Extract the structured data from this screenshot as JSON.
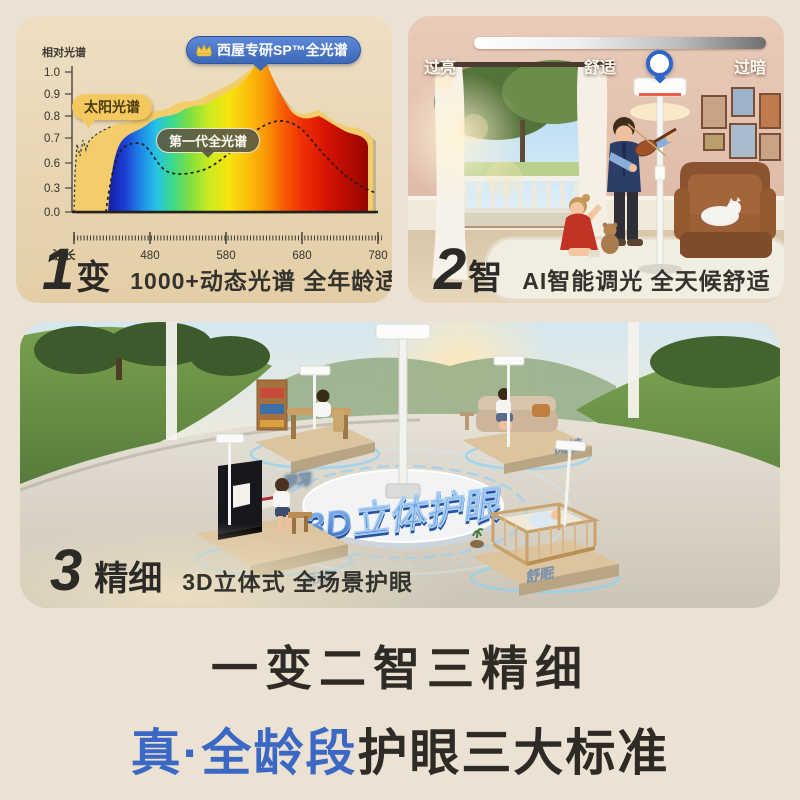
{
  "page": {
    "background": "#ebe2d3"
  },
  "panel_spectrum": {
    "axis_y_label": "相对光谱",
    "y_ticks": [
      "1.0",
      "0.9",
      "0.8",
      "0.7",
      "0.6",
      "0.3",
      "0.0"
    ],
    "axis_x_label": "波长",
    "x_ticks": [
      "480",
      "580",
      "680",
      "780"
    ],
    "badge_title": "西屋专研SP™全光谱",
    "label_sun": "太阳光谱",
    "label_gen1": "第一代全光谱",
    "index": "1",
    "keyword": "变",
    "caption": "1000+动态光谱 全年龄适配"
  },
  "panel_dimming": {
    "label_left": "过亮",
    "label_center": "舒适",
    "label_right": "过暗",
    "slider_value_percent": 55,
    "index": "2",
    "keyword": "智",
    "caption": "AI智能调光 全天候舒适"
  },
  "panel_scene": {
    "center_text": "3D立体护眼",
    "labels": {
      "study": "学习",
      "reading": "阅读",
      "sport": "运动",
      "sleep": "舒眠"
    },
    "index": "3",
    "keyword": "精细",
    "caption": "3D立体式 全场景护眼"
  },
  "footer": {
    "line1": "一变二智三精细",
    "line2_highlight": "真·全龄段",
    "line2_rest": "护眼三大标准"
  },
  "colors": {
    "accent_blue": "#3a68c4",
    "badge_blue": "#4b79c8",
    "sun_yellow": "#f3c95f",
    "gen1_gray": "#6b6852"
  },
  "chart_data": {
    "type": "area",
    "title": "西屋专研SP™全光谱",
    "xlabel": "波长",
    "ylabel": "相对光谱",
    "x_ticks": [
      480,
      580,
      680,
      780
    ],
    "y_ticks": [
      0.0,
      0.3,
      0.6,
      0.7,
      0.8,
      0.9,
      1.0
    ],
    "ylim": [
      0,
      1.05
    ],
    "legend_position": "inline-callouts",
    "grid": false,
    "series": [
      {
        "name": "太阳光谱",
        "style": "filled-yellow-outline-dashed",
        "x": [
          410,
          420,
          430,
          440,
          460,
          480,
          500,
          520,
          540,
          560,
          580,
          600,
          620,
          630,
          640,
          660,
          680,
          700,
          720,
          740,
          760,
          780
        ],
        "y": [
          0.05,
          0.72,
          0.62,
          0.7,
          0.74,
          0.78,
          0.82,
          0.85,
          0.84,
          0.88,
          0.9,
          0.93,
          0.99,
          1.02,
          0.95,
          0.88,
          0.84,
          0.8,
          0.78,
          0.76,
          0.72,
          0.65
        ]
      },
      {
        "name": "西屋专研SP™全光谱",
        "style": "rainbow-gradient-area",
        "x": [
          430,
          440,
          450,
          460,
          480,
          500,
          520,
          540,
          560,
          580,
          600,
          620,
          630,
          640,
          660,
          680,
          700,
          720,
          740,
          760,
          780
        ],
        "y": [
          0.02,
          0.45,
          0.66,
          0.7,
          0.74,
          0.79,
          0.82,
          0.83,
          0.85,
          0.88,
          0.92,
          1.0,
          1.05,
          0.92,
          0.82,
          0.78,
          0.74,
          0.7,
          0.68,
          0.64,
          0.6
        ]
      },
      {
        "name": "第一代全光谱",
        "style": "dashed-black-line",
        "x": [
          440,
          450,
          460,
          470,
          480,
          500,
          520,
          540,
          560,
          580,
          600,
          620,
          640,
          660,
          680,
          700,
          720,
          740,
          760,
          780
        ],
        "y": [
          0.05,
          0.4,
          0.6,
          0.68,
          0.66,
          0.56,
          0.54,
          0.55,
          0.56,
          0.6,
          0.67,
          0.74,
          0.78,
          0.77,
          0.7,
          0.6,
          0.48,
          0.38,
          0.3,
          0.25
        ]
      }
    ]
  }
}
